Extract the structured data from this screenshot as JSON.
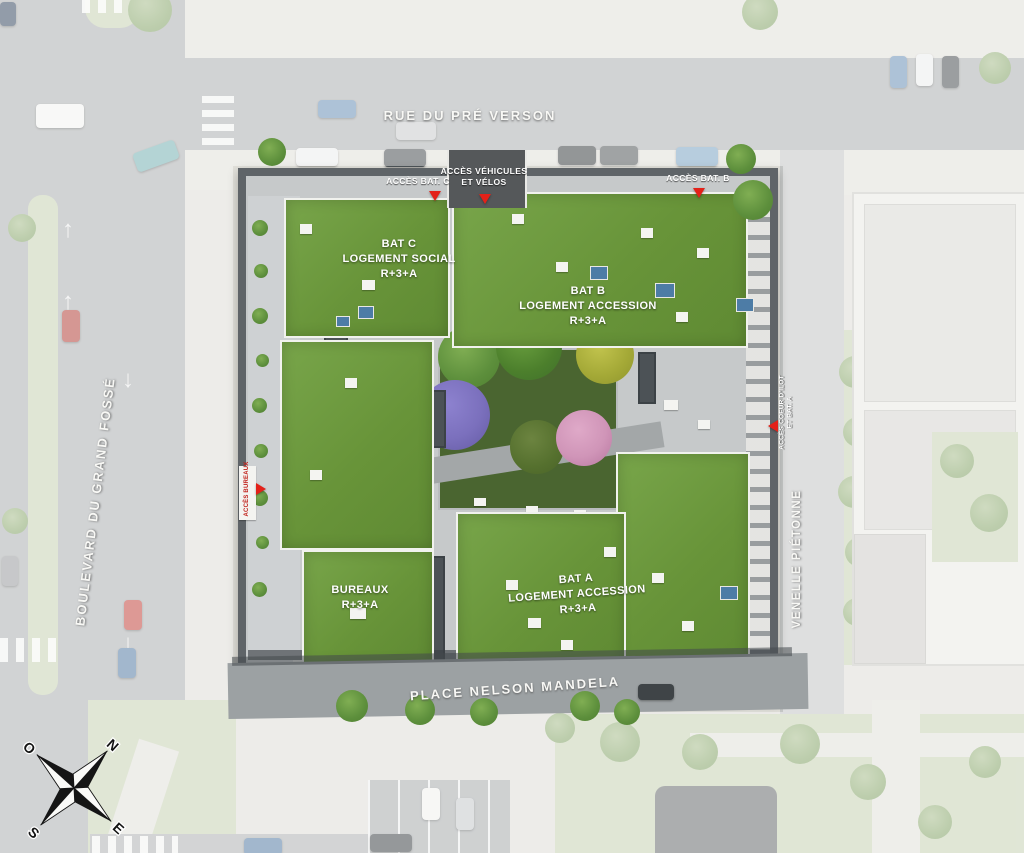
{
  "streets": {
    "top": "RUE DU PRÉ VERSON",
    "left": "BOULEVARD DU GRAND FOSSÉ",
    "right": "VENELLE PIÉTONNE",
    "bottom": "PLACE NELSON MANDELA"
  },
  "buildings": [
    {
      "id": "bat-c",
      "title": "BAT C",
      "subtitle": "LOGEMENT SOCIAL",
      "floors": "R+3+A"
    },
    {
      "id": "bat-b",
      "title": "BAT B",
      "subtitle": "LOGEMENT ACCESSION",
      "floors": "R+3+A"
    },
    {
      "id": "bat-a",
      "title": "BAT A",
      "subtitle": "LOGEMENT ACCESSION",
      "floors": "R+3+A"
    },
    {
      "id": "bureaux",
      "title": "BUREAUX",
      "subtitle": "",
      "floors": "R+3+A"
    }
  ],
  "access": [
    {
      "id": "acces-bat-c",
      "line1": "ACCÈS BAT. C",
      "line2": ""
    },
    {
      "id": "acces-vehicules",
      "line1": "ACCÈS VÉHICULES",
      "line2": "ET VÉLOS"
    },
    {
      "id": "acces-bat-b",
      "line1": "ACCÈS BAT. B",
      "line2": ""
    },
    {
      "id": "acces-coeur-ilot",
      "line1": "ACCÈS COEUR D'ILOT",
      "line2": "ET BAT. A"
    },
    {
      "id": "acces-bureaux",
      "line1": "ACCÈS",
      "line2": "BUREAUX"
    }
  ],
  "compass": {
    "north": "N",
    "east": "E",
    "south": "S",
    "west": "O"
  },
  "colors": {
    "accent_red": "#e32119",
    "roof_green": "#689439",
    "facade_gray": "#5f6468",
    "road_gray": "#aeb1b2",
    "garden_green": "#4a6530",
    "tree_purple": "#7b70bd",
    "tree_pink": "#d095b8"
  }
}
